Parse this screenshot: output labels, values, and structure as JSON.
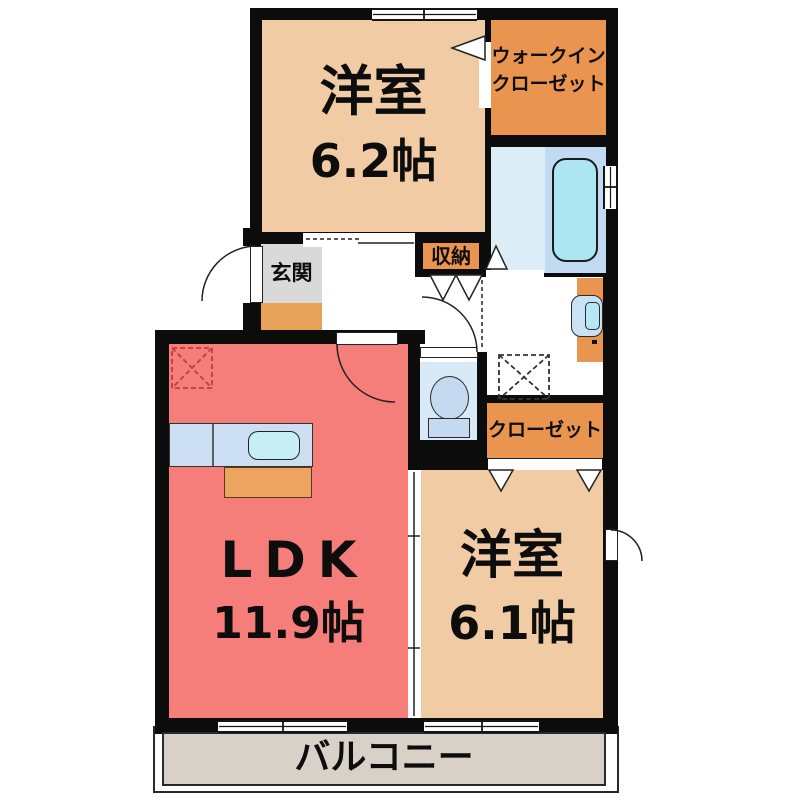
{
  "plan": {
    "type": "apartment-floor-plan",
    "rooms": {
      "bedroom1": {
        "name": "洋室",
        "size": "6.2帖"
      },
      "wic": {
        "line1": "ウォークイン",
        "line2": "クローゼット"
      },
      "storage": {
        "name": "収納"
      },
      "entrance": {
        "name": "玄関"
      },
      "closet": {
        "name": "クローゼット"
      },
      "ldk": {
        "name": "LDK",
        "size": "11.9帖"
      },
      "bedroom2": {
        "name": "洋室",
        "size": "6.1帖"
      },
      "balcony": {
        "name": "バルコニー"
      }
    },
    "colors": {
      "wall": "#0c0c0c",
      "bedroom_peach": "#f0cba4",
      "closet_orange": "#e9954f",
      "entrance_gray": "#d9d9d9",
      "entrance_step": "#e8a258",
      "ldk_red": "#f67e7a",
      "balcony_beige": "#d8d1c7",
      "bath_floor": "#ddedf8",
      "bath_right": "#c2dbf2",
      "bathtub": "#abe6f2",
      "toilet_room": "#d8eaf8",
      "fixture_blue": "#c5daf1",
      "counter_blue": "#ccdff2",
      "sink_blue": "#c6eff5",
      "counter_front_orange": "#eda45e",
      "basin_outer": "#c9e2f4",
      "basin_inner": "#b5e8f4"
    }
  }
}
